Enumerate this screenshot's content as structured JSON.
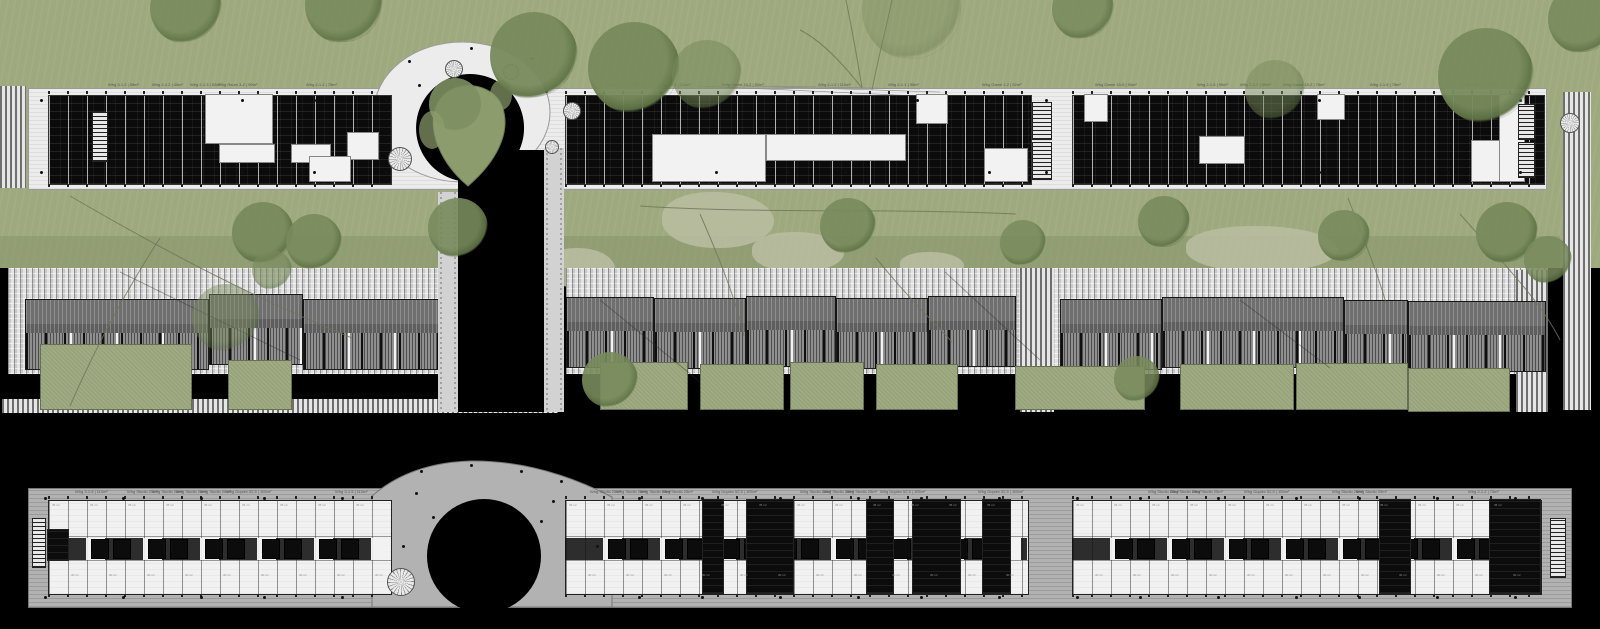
{
  "title": "residential site plan – two linear housing slabs with loop courtyard, carports and gardens",
  "colors": {
    "background": "#000000",
    "grass": "#9ea97e",
    "grass_dark": "#8f9c73",
    "blob": "#b6bd9e",
    "tree": "#798b5c",
    "tree_dark": "#5f7446",
    "deck_upper": "#ececec",
    "deck_lower": "#b2b2b2",
    "paver": "#dedede",
    "carport_roof": "#6f6f6f",
    "parking": "#8f8f8f",
    "garden": "#9fab82",
    "building_dark": "#0b0b0b",
    "building_light": "#f1f1f1",
    "label_text": "#555555"
  },
  "top_floor": {
    "label_row_y": 83,
    "labels": [
      [
        108,
        "Whg 3-1.2 | 55m²"
      ],
      [
        152,
        "Whg 2-1.2 | 45m²"
      ],
      [
        190,
        "Whg 2-1.3 | 52m²"
      ],
      [
        218,
        "Whg Raum 3-2 | 90m²"
      ],
      [
        306,
        "Whg 2-1.1 | 75m²"
      ],
      [
        610,
        "Whg 2-1.2 | 75m²"
      ],
      [
        658,
        "Whg 3-1.2 | 110m²"
      ],
      [
        722,
        "Whg Game 15-2 | 92m²"
      ],
      [
        818,
        "Whg 2-1.2 | 110m²"
      ],
      [
        888,
        "Whg 2-1.1 | 55m²"
      ],
      [
        982,
        "Whg Game 1-2 | 92m²"
      ],
      [
        1095,
        "Whg Game 15-5 | 90m²"
      ],
      [
        1197,
        "Whg 2-1.5 | 90m²"
      ],
      [
        1240,
        "Whg 2-1.2 | 90m²"
      ],
      [
        1283,
        "Whg Game 15-2 | 75m²"
      ],
      [
        1370,
        "Whg 2-1.5 | 75m²"
      ],
      [
        1462,
        "Whg Studio | 25m²"
      ]
    ],
    "deck": [
      28,
      88,
      1517,
      100
    ],
    "wings": [
      {
        "x": 48,
        "y": 95,
        "w": 342,
        "h": 88,
        "whites": [
          [
            158,
            0,
            66,
            48
          ],
          [
            172,
            50,
            54,
            17
          ],
          [
            244,
            50,
            38,
            17
          ],
          [
            300,
            38,
            30,
            26
          ],
          [
            262,
            62,
            40,
            24
          ]
        ]
      },
      {
        "x": 565,
        "y": 95,
        "w": 465,
        "h": 88,
        "whites": [
          [
            88,
            40,
            112,
            46
          ],
          [
            202,
            40,
            138,
            25
          ],
          [
            352,
            0,
            30,
            28
          ],
          [
            420,
            54,
            42,
            32
          ]
        ]
      },
      {
        "x": 1072,
        "y": 95,
        "w": 471,
        "h": 88,
        "whites": [
          [
            13,
            0,
            22,
            26
          ],
          [
            128,
            42,
            44,
            26
          ],
          [
            246,
            0,
            26,
            24
          ],
          [
            400,
            46,
            28,
            40
          ],
          [
            428,
            0,
            24,
            86
          ]
        ]
      }
    ],
    "stairs": [
      [
        92,
        112,
        14,
        48
      ],
      [
        1032,
        102,
        18,
        36
      ],
      [
        1032,
        142,
        18,
        36
      ],
      [
        1518,
        104,
        15,
        34
      ],
      [
        1518,
        142,
        15,
        34
      ]
    ],
    "left_brick_path": [
      0,
      86,
      26,
      102
    ],
    "rings": [
      [
        445,
        60,
        16
      ],
      [
        503,
        64,
        14
      ],
      [
        563,
        102,
        16
      ],
      [
        545,
        140,
        12
      ],
      [
        388,
        147,
        22
      ],
      [
        1560,
        113,
        18
      ]
    ]
  },
  "landscape": {
    "grass": [
      0,
      0,
      1600,
      268
    ],
    "dark_strip": [
      0,
      236,
      1560,
      32
    ],
    "blobs": [
      [
        662,
        192,
        112,
        56
      ],
      [
        752,
        232,
        92,
        40
      ],
      [
        1186,
        226,
        152,
        46
      ],
      [
        900,
        252,
        64,
        26
      ],
      [
        545,
        248,
        70,
        40
      ]
    ],
    "trees": [
      [
        150,
        -28,
        72,
        0.9
      ],
      [
        305,
        -34,
        78,
        0.9
      ],
      [
        490,
        12,
        88,
        0.95
      ],
      [
        588,
        22,
        92,
        0.95
      ],
      [
        672,
        40,
        70,
        0.55
      ],
      [
        862,
        -40,
        100,
        0.35
      ],
      [
        1052,
        -22,
        62,
        0.85
      ],
      [
        1245,
        60,
        60,
        0.5
      ],
      [
        1438,
        28,
        96,
        0.95
      ],
      [
        1548,
        -16,
        70,
        0.9
      ],
      [
        232,
        202,
        62,
        0.95
      ],
      [
        286,
        214,
        56,
        0.9
      ],
      [
        428,
        198,
        60,
        0.9
      ],
      [
        820,
        198,
        56,
        0.9
      ],
      [
        1000,
        220,
        46,
        0.85
      ],
      [
        1138,
        196,
        52,
        0.9
      ],
      [
        1318,
        210,
        52,
        0.9
      ],
      [
        1476,
        202,
        62,
        0.95
      ],
      [
        1524,
        236,
        48,
        0.85
      ],
      [
        192,
        284,
        68,
        0.45
      ],
      [
        582,
        352,
        56,
        0.9
      ],
      [
        1114,
        356,
        46,
        0.85
      ],
      [
        252,
        250,
        40,
        0.6
      ]
    ],
    "paver_bands": [
      [
        8,
        268,
        430,
        106
      ],
      [
        566,
        268,
        982,
        106
      ]
    ],
    "hatch_strips": [
      [
        1020,
        268,
        34,
        144
      ],
      [
        2,
        399,
        556,
        14
      ],
      [
        1516,
        270,
        32,
        142
      ],
      [
        1563,
        92,
        28,
        318
      ]
    ],
    "carports": [
      [
        25,
        182,
        299
      ],
      [
        209,
        92,
        294
      ],
      [
        303,
        134,
        299
      ],
      [
        566,
        86,
        297
      ],
      [
        654,
        90,
        298
      ],
      [
        746,
        88,
        296
      ],
      [
        836,
        90,
        298
      ],
      [
        928,
        86,
        296
      ],
      [
        1060,
        100,
        299
      ],
      [
        1162,
        180,
        297
      ],
      [
        1344,
        62,
        300
      ],
      [
        1408,
        136,
        301
      ]
    ],
    "carport_roof_h": 34,
    "carport_park_h": 36,
    "gardens": [
      [
        40,
        150,
        344,
        64
      ],
      [
        228,
        62,
        360,
        48
      ],
      [
        600,
        86,
        362,
        46
      ],
      [
        700,
        82,
        364,
        44
      ],
      [
        790,
        72,
        362,
        46
      ],
      [
        876,
        80,
        364,
        44
      ],
      [
        1015,
        128,
        366,
        42
      ],
      [
        1180,
        112,
        364,
        44
      ],
      [
        1296,
        110,
        363,
        45
      ],
      [
        1408,
        100,
        368,
        42
      ]
    ]
  },
  "bottom_floor": {
    "label_row_y": 490,
    "labels": [
      [
        75,
        "Whg 3-1.5 | 110m²"
      ],
      [
        127,
        "Whg Studio 25m²"
      ],
      [
        152,
        "Whg Studio 25m²"
      ],
      [
        176,
        "Whg Studio 25m²"
      ],
      [
        200,
        "Whg Studio 25m²"
      ],
      [
        226,
        "Whg Duplex 52,5 | 105m²"
      ],
      [
        335,
        "Whg 3-1.5 | 110m²"
      ],
      [
        590,
        "Whg Studio 25m²"
      ],
      [
        616,
        "Whg Studio 25m²"
      ],
      [
        640,
        "Whg Studio 25m²"
      ],
      [
        662,
        "Whg Studio 25m²"
      ],
      [
        712,
        "Whg Duplex 52,5 | 105m²"
      ],
      [
        800,
        "Whg Studio 25m²"
      ],
      [
        823,
        "Whg Studio 25m²"
      ],
      [
        846,
        "Whg Studio 25m²"
      ],
      [
        880,
        "Whg Duplex 52,5 | 105m²"
      ],
      [
        978,
        "Whg Duplex 52,5 | 105m²"
      ],
      [
        1148,
        "Whg Studio 25m²"
      ],
      [
        1170,
        "Whg Studio 25m²"
      ],
      [
        1192,
        "Whg Studio 25m²"
      ],
      [
        1244,
        "Whg Duplex 52,5 | 105m²"
      ],
      [
        1332,
        "Whg Studio 25m²"
      ],
      [
        1356,
        "Whg Studio 25m²"
      ],
      [
        1468,
        "Whg 2-1.2 | 75m²"
      ]
    ],
    "deck": [
      28,
      488,
      1542,
      118
    ],
    "wings": [
      {
        "x": 48,
        "y": 500,
        "w": 342,
        "h": 93,
        "blacks": [
          [
            0,
            30,
            20,
            30
          ]
        ]
      },
      {
        "x": 565,
        "y": 500,
        "w": 462,
        "h": 93,
        "blacks": [
          [
            138,
            0,
            20,
            93
          ],
          [
            182,
            0,
            46,
            93
          ],
          [
            302,
            0,
            26,
            93
          ],
          [
            348,
            0,
            47,
            93
          ],
          [
            418,
            0,
            27,
            93
          ]
        ]
      },
      {
        "x": 1072,
        "y": 500,
        "w": 468,
        "h": 93,
        "blacks": [
          [
            308,
            0,
            30,
            93
          ],
          [
            418,
            0,
            50,
            93
          ]
        ]
      }
    ],
    "stairs": [
      [
        32,
        518,
        12,
        48
      ],
      [
        1550,
        518,
        14,
        58
      ]
    ],
    "room_texts": [
      "35 m²",
      "30 m²"
    ],
    "rings": [
      [
        387,
        568,
        26
      ]
    ]
  }
}
